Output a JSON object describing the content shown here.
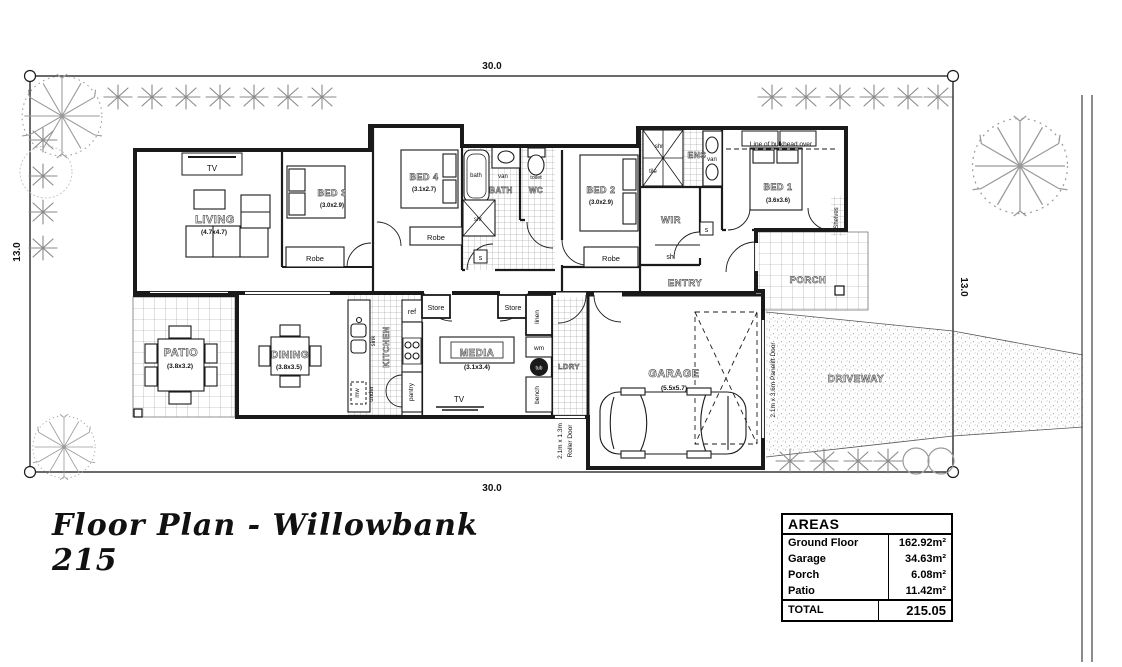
{
  "title": "Floor Plan - Willowbank 215",
  "site": {
    "dim_top": "30.0",
    "dim_bottom": "30.0",
    "dim_left": "13.0",
    "dim_right": "13.0"
  },
  "rooms": {
    "living": {
      "name": "LIVING",
      "size": "(4.7x4.7)"
    },
    "bed3": {
      "name": "BED 3",
      "size": "(3.0x2.9)"
    },
    "bed4": {
      "name": "BED 4",
      "size": "(3.1x2.7)"
    },
    "bed2": {
      "name": "BED 2",
      "size": "(3.0x2.9)"
    },
    "bed1": {
      "name": "BED 1",
      "size": "(3.6x3.6)"
    },
    "dining": {
      "name": "DINING",
      "size": "(3.8x3.5)"
    },
    "patio": {
      "name": "PATIO",
      "size": "(3.8x3.2)"
    },
    "media": {
      "name": "MEDIA",
      "size": "(3.1x3.4)"
    },
    "garage": {
      "name": "GARAGE",
      "size": "(5.5x5.7)"
    },
    "kitchen": "KITCHEN",
    "bath": "BATH",
    "wc": "WC",
    "ens": "ENS",
    "wir": "WIR",
    "entry": "ENTRY",
    "porch": "PORCH",
    "ldry": "LDRY",
    "driveway": "DRIVEWAY"
  },
  "labels": {
    "tv": "TV",
    "robe": "Robe",
    "bath_fixture": "bath",
    "van": "van",
    "toilet": "toilet",
    "shr": "shr",
    "tile": "tile",
    "sh": "sh.",
    "smoke": "s",
    "shelves": "Shelves",
    "bulkhead": "Line of bulkhead over",
    "store": "Store",
    "linen": "linen",
    "wm": "wm",
    "tub": "tub",
    "bench": "bench",
    "ref": "ref",
    "sink": "sink",
    "pantry": "pantry",
    "mw": "mw",
    "under": "under",
    "roller_door_1": "2.1m x 1.3m",
    "roller_door_2": "Roller Door",
    "panelift_door": "2.1m x 3.6m Panelift Door"
  },
  "areas_table": {
    "header": "AREAS",
    "rows": [
      {
        "label": "Ground Floor",
        "value": "162.92m²"
      },
      {
        "label": "Garage",
        "value": "34.63m²"
      },
      {
        "label": "Porch",
        "value": "6.08m²"
      },
      {
        "label": "Patio",
        "value": "11.42m²"
      }
    ],
    "total_label": "TOTAL",
    "total_value": "215.05"
  }
}
